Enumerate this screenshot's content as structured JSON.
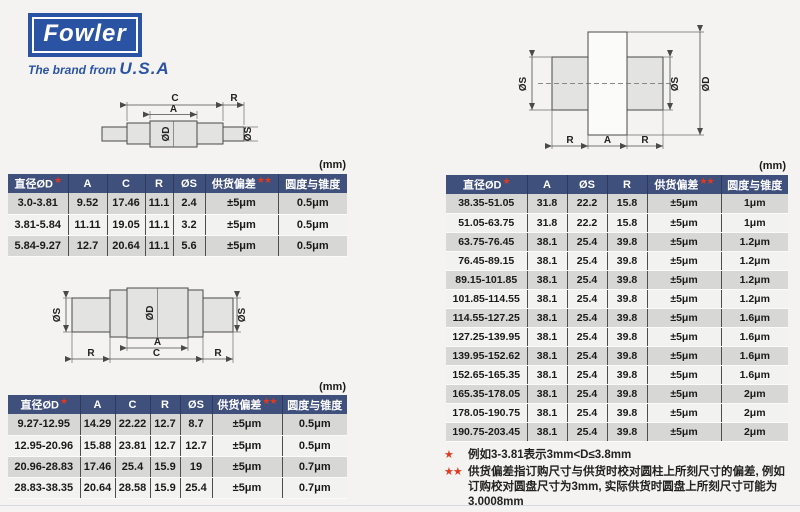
{
  "brand": {
    "logo_text": "Fowler",
    "tagline_prefix": "The brand from",
    "tagline_country": "U.S.A"
  },
  "units_label": "(mm)",
  "dim_labels": {
    "C": "C",
    "A": "A",
    "R": "R",
    "OD": "ØD",
    "OS": "ØS"
  },
  "tables": {
    "small1": {
      "headers": [
        {
          "label": "直径ØD",
          "stars": 1
        },
        {
          "label": "A",
          "stars": 0
        },
        {
          "label": "C",
          "stars": 0
        },
        {
          "label": "R",
          "stars": 0
        },
        {
          "label": "ØS",
          "stars": 0
        },
        {
          "label": "供货偏差",
          "stars": 2
        },
        {
          "label": "圆度与锥度",
          "stars": 0
        }
      ],
      "rows": [
        [
          "3.0-3.81",
          "9.52",
          "17.46",
          "11.1",
          "2.4",
          "±5μm",
          "0.5μm"
        ],
        [
          "3.81-5.84",
          "11.11",
          "19.05",
          "11.1",
          "3.2",
          "±5μm",
          "0.5μm"
        ],
        [
          "5.84-9.27",
          "12.7",
          "20.64",
          "11.1",
          "5.6",
          "±5μm",
          "0.5μm"
        ]
      ]
    },
    "small2": {
      "headers": [
        {
          "label": "直径ØD",
          "stars": 1
        },
        {
          "label": "A",
          "stars": 0
        },
        {
          "label": "C",
          "stars": 0
        },
        {
          "label": "R",
          "stars": 0
        },
        {
          "label": "ØS",
          "stars": 0
        },
        {
          "label": "供货偏差",
          "stars": 2
        },
        {
          "label": "圆度与锥度",
          "stars": 0
        }
      ],
      "rows": [
        [
          "9.27-12.95",
          "14.29",
          "22.22",
          "12.7",
          "8.7",
          "±5μm",
          "0.5μm"
        ],
        [
          "12.95-20.96",
          "15.88",
          "23.81",
          "12.7",
          "12.7",
          "±5μm",
          "0.5μm"
        ],
        [
          "20.96-28.83",
          "17.46",
          "25.4",
          "15.9",
          "19",
          "±5μm",
          "0.7μm"
        ],
        [
          "28.83-38.35",
          "20.64",
          "28.58",
          "15.9",
          "25.4",
          "±5μm",
          "0.7μm"
        ]
      ]
    },
    "large": {
      "headers": [
        {
          "label": "直径ØD",
          "stars": 1
        },
        {
          "label": "A",
          "stars": 0
        },
        {
          "label": "ØS",
          "stars": 0
        },
        {
          "label": "R",
          "stars": 0
        },
        {
          "label": "供货偏差",
          "stars": 2
        },
        {
          "label": "圆度与锥度",
          "stars": 0
        }
      ],
      "rows": [
        [
          "38.35-51.05",
          "31.8",
          "22.2",
          "15.8",
          "±5μm",
          "1μm"
        ],
        [
          "51.05-63.75",
          "31.8",
          "22.2",
          "15.8",
          "±5μm",
          "1μm"
        ],
        [
          "63.75-76.45",
          "38.1",
          "25.4",
          "39.8",
          "±5μm",
          "1.2μm"
        ],
        [
          "76.45-89.15",
          "38.1",
          "25.4",
          "39.8",
          "±5μm",
          "1.2μm"
        ],
        [
          "89.15-101.85",
          "38.1",
          "25.4",
          "39.8",
          "±5μm",
          "1.2μm"
        ],
        [
          "101.85-114.55",
          "38.1",
          "25.4",
          "39.8",
          "±5μm",
          "1.2μm"
        ],
        [
          "114.55-127.25",
          "38.1",
          "25.4",
          "39.8",
          "±5μm",
          "1.6μm"
        ],
        [
          "127.25-139.95",
          "38.1",
          "25.4",
          "39.8",
          "±5μm",
          "1.6μm"
        ],
        [
          "139.95-152.62",
          "38.1",
          "25.4",
          "39.8",
          "±5μm",
          "1.6μm"
        ],
        [
          "152.65-165.35",
          "38.1",
          "25.4",
          "39.8",
          "±5μm",
          "1.6μm"
        ],
        [
          "165.35-178.05",
          "38.1",
          "25.4",
          "39.8",
          "±5μm",
          "2μm"
        ],
        [
          "178.05-190.75",
          "38.1",
          "25.4",
          "39.8",
          "±5μm",
          "2μm"
        ],
        [
          "190.75-203.45",
          "38.1",
          "25.4",
          "39.8",
          "±5μm",
          "2μm"
        ]
      ]
    }
  },
  "notes": [
    {
      "marker": "★",
      "text": "例如3-3.81表示3mm<D≤3.8mm"
    },
    {
      "marker": "★★",
      "text": "供货偏差指订购尺寸与供货时校对圆柱上所刻尺寸的偏差, 例如订购校对圆盘尺寸为3mm, 实际供货时圆盘上所刻尺寸可能为3.0008mm"
    }
  ],
  "colors": {
    "brand_blue": "#2B53A4",
    "table_header_bg": "#40507C",
    "row_alt_gray": "#D7D7D6",
    "star_red": "#E03A1E"
  }
}
